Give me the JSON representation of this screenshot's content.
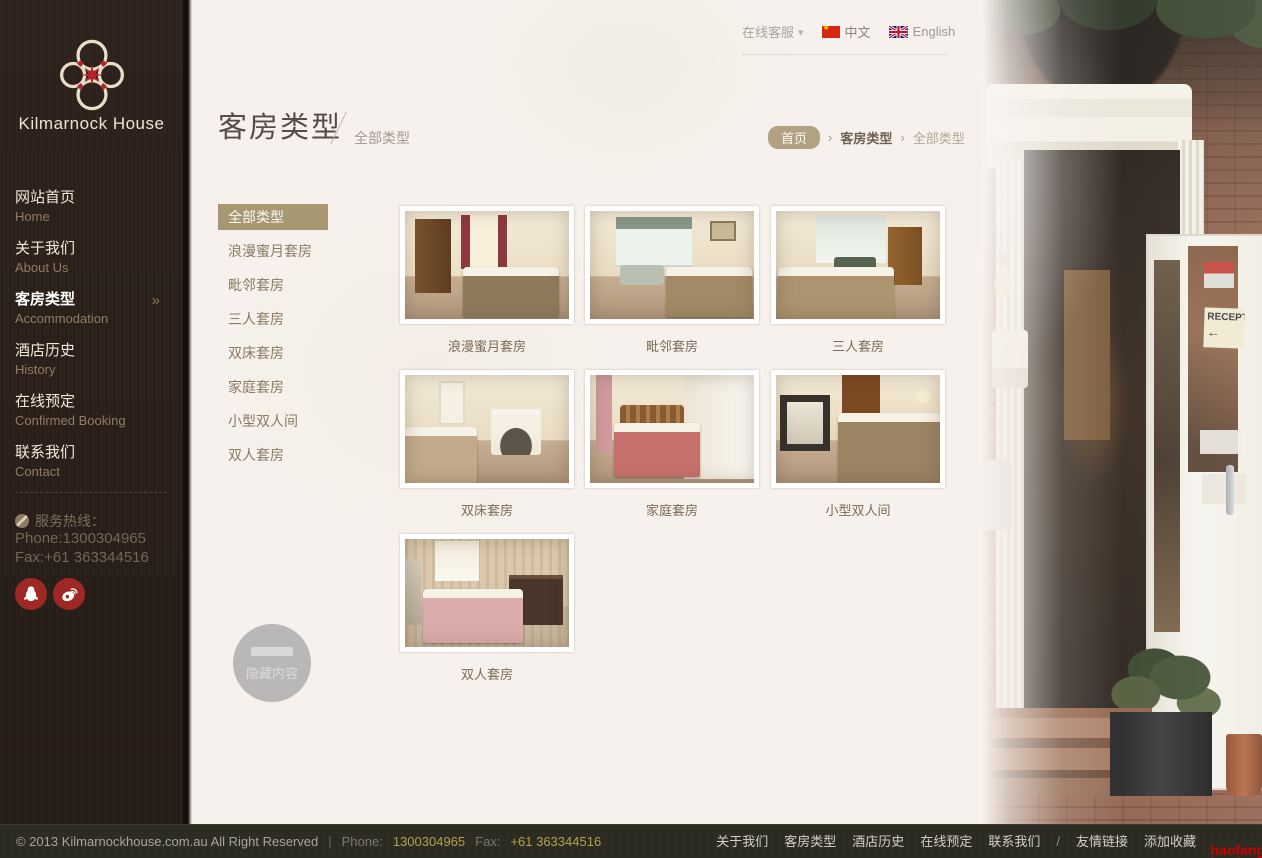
{
  "brand": {
    "name": "Kilmarnock House"
  },
  "topbar": {
    "service_label": "在线客服",
    "lang_zh": "中文",
    "lang_en": "English"
  },
  "sidebar": {
    "items": [
      {
        "zh": "网站首页",
        "en": "Home"
      },
      {
        "zh": "关于我们",
        "en": "About Us"
      },
      {
        "zh": "客房类型",
        "en": "Accommodation"
      },
      {
        "zh": "酒店历史",
        "en": "History"
      },
      {
        "zh": "在线预定",
        "en": "Confirmed Booking"
      },
      {
        "zh": "联系我们",
        "en": "Contact"
      }
    ],
    "active_item": "客房类型",
    "hotline_label": "服务热线：",
    "phone": "Phone:1300304965",
    "fax": "Fax:+61 363344516"
  },
  "page": {
    "title": "客房类型",
    "subtitle": "全部类型"
  },
  "breadcrumb": {
    "home": "首页",
    "level1": "客房类型",
    "level2": "全部类型"
  },
  "subnav": {
    "items": [
      "全部类型",
      "浪漫蜜月套房",
      "毗邻套房",
      "三人套房",
      "双床套房",
      "家庭套房",
      "小型双人间",
      "双人套房"
    ],
    "active_index": 0
  },
  "rooms": [
    {
      "caption": "浪漫蜜月套房"
    },
    {
      "caption": "毗邻套房"
    },
    {
      "caption": "三人套房"
    },
    {
      "caption": "双床套房"
    },
    {
      "caption": "家庭套房"
    },
    {
      "caption": "小型双人间"
    },
    {
      "caption": "双人套房"
    }
  ],
  "hidden_toggle": {
    "label": "隐藏内容"
  },
  "photo": {
    "reception_sign": "RECEPTION"
  },
  "footer": {
    "copyright": "© 2013 Kilmarnockhouse.com.au All Right Reserved",
    "pipe": "|",
    "phone_label": "Phone:",
    "phone_value": "1300304965",
    "fax_label": "Fax:",
    "fax_value": "+61 363344516",
    "links": [
      "关于我们",
      "客房类型",
      "酒店历史",
      "在线预定",
      "联系我们"
    ],
    "slash": "/",
    "extra_links": [
      "友情链接",
      "添加收藏"
    ]
  },
  "watermark": {
    "line1": "haofang",
    "line2": "haofang"
  },
  "colors": {
    "sidebar_bg": "#2b211b",
    "accent_red": "#9e2823",
    "breadcrumb_pill": "#b2a183",
    "subnav_active_bg": "#a79773",
    "footer_gold": "#b3a04a",
    "watermark_red": "#cc0000"
  }
}
